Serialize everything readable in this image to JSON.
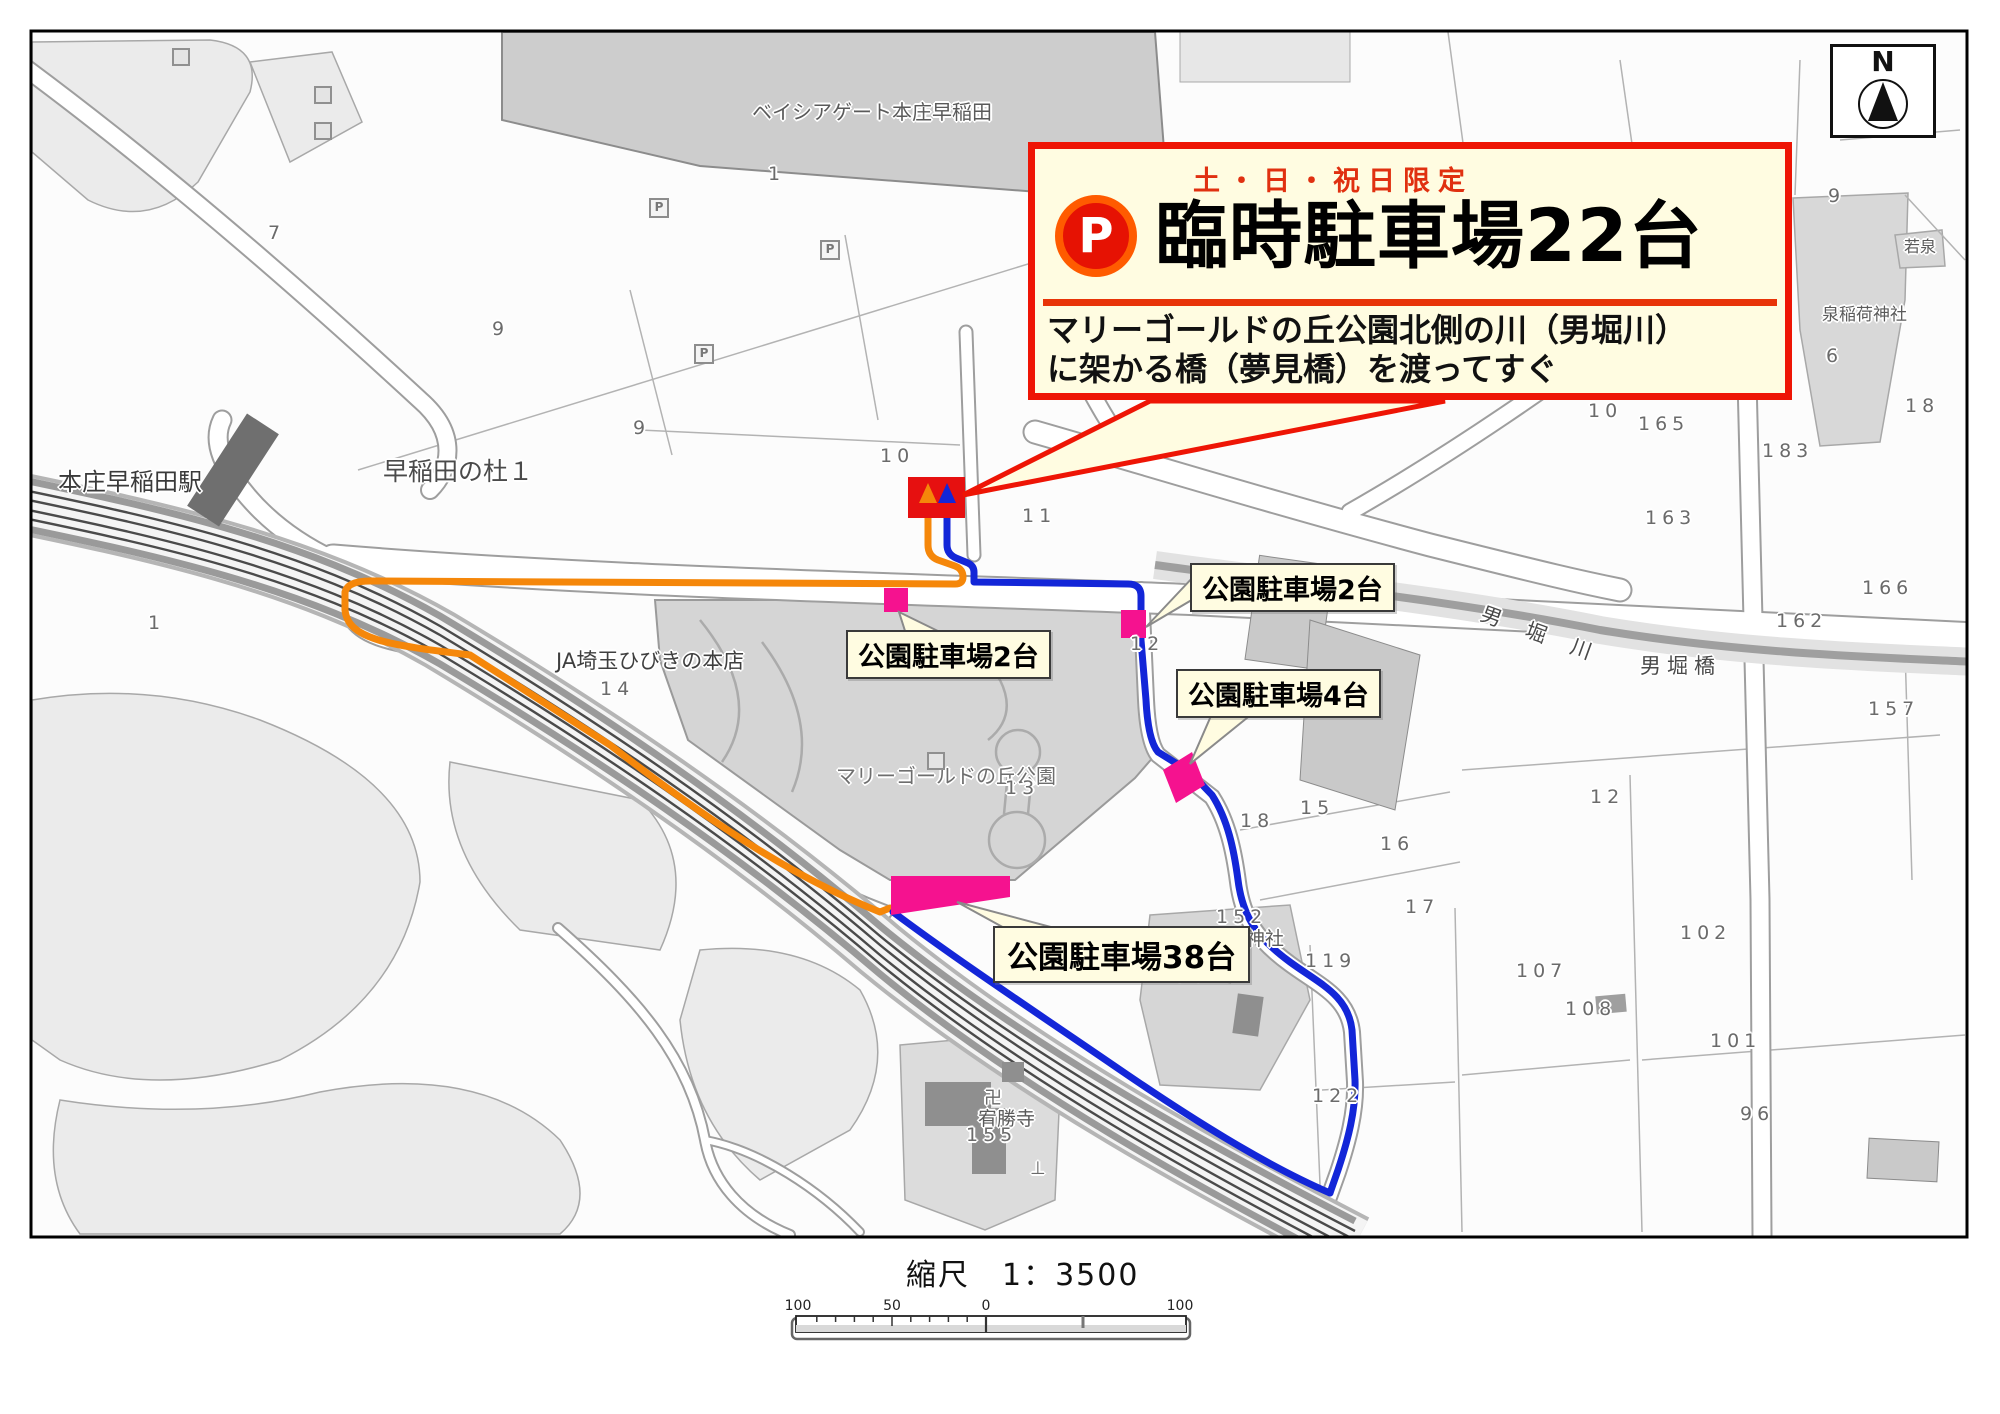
{
  "callout": {
    "badge": "P",
    "subtitle": "土・日・祝日限定",
    "title": "臨時駐車場22台",
    "body_line1": "マリーゴールドの丘公園北側の川（男堀川）",
    "body_line2": "に架かる橋（夢見橋）を渡ってすぐ"
  },
  "parking_labels": {
    "lot2_right": "公園駐車場2台",
    "lot2_left": "公園駐車場2台",
    "lot4": "公園駐車場4台",
    "lot38": "公園駐車場38台"
  },
  "compass": {
    "north": "N"
  },
  "scale": {
    "caption": "縮尺　1：3500",
    "ticks": [
      "100",
      "50",
      "0",
      "100"
    ]
  },
  "map": {
    "places": [
      {
        "t": "本庄早稲田駅",
        "x": 58,
        "y": 462,
        "s": 24,
        "c": "#3a3a3a"
      },
      {
        "t": "早稲田の杜１",
        "x": 383,
        "y": 452,
        "s": 25,
        "c": "#4a4a4a"
      },
      {
        "t": "ベイシアゲート本庄早稲田",
        "x": 752,
        "y": 96,
        "s": 20,
        "c": "#5a5a5a"
      },
      {
        "t": "JA埼玉ひびきの本店",
        "x": 556,
        "y": 645,
        "s": 21,
        "c": "#3f3f3f"
      },
      {
        "t": "マリーゴールドの丘公園",
        "x": 836,
        "y": 760,
        "s": 20,
        "c": "#6e6e6e"
      },
      {
        "t": "金鑚神社",
        "x": 1208,
        "y": 924,
        "s": 19,
        "c": "#5a5a5a"
      },
      {
        "t": "宥勝寺",
        "x": 978,
        "y": 1104,
        "s": 19,
        "c": "#5a5a5a"
      },
      {
        "t": "男 堀 川",
        "x": 1487,
        "y": 598,
        "s": 21,
        "c": "#4a4a4a",
        "r": 20,
        "ls": 10
      },
      {
        "t": "男堀橋",
        "x": 1640,
        "y": 650,
        "s": 21,
        "c": "#4a4a4a",
        "ls": 6
      },
      {
        "t": "泉稲荷神社",
        "x": 1822,
        "y": 300,
        "s": 17,
        "c": "#5a5a5a"
      },
      {
        "t": "若泉",
        "x": 1904,
        "y": 233,
        "s": 16,
        "c": "#5a5a5a"
      },
      {
        "t": "卍",
        "x": 984,
        "y": 1084,
        "s": 18,
        "c": "#6a6a6a"
      },
      {
        "t": "⊥",
        "x": 1030,
        "y": 1158,
        "s": 18,
        "c": "#6a6a6a"
      }
    ],
    "numbers": [
      {
        "t": "7",
        "x": 268,
        "y": 222
      },
      {
        "t": "9",
        "x": 492,
        "y": 318
      },
      {
        "t": "9",
        "x": 633,
        "y": 417
      },
      {
        "t": "1",
        "x": 768,
        "y": 163
      },
      {
        "t": "10",
        "x": 880,
        "y": 445
      },
      {
        "t": "11",
        "x": 1022,
        "y": 505
      },
      {
        "t": "12",
        "x": 1130,
        "y": 633
      },
      {
        "t": "13",
        "x": 1005,
        "y": 777
      },
      {
        "t": "14",
        "x": 600,
        "y": 678
      },
      {
        "t": "15",
        "x": 1300,
        "y": 797
      },
      {
        "t": "16",
        "x": 1380,
        "y": 833
      },
      {
        "t": "17",
        "x": 1405,
        "y": 896
      },
      {
        "t": "18",
        "x": 1240,
        "y": 810
      },
      {
        "t": "12",
        "x": 1590,
        "y": 786
      },
      {
        "t": "10",
        "x": 1588,
        "y": 400
      },
      {
        "t": "165",
        "x": 1638,
        "y": 413
      },
      {
        "t": "183",
        "x": 1762,
        "y": 440
      },
      {
        "t": "163",
        "x": 1645,
        "y": 507
      },
      {
        "t": "162",
        "x": 1776,
        "y": 610
      },
      {
        "t": "166",
        "x": 1862,
        "y": 577
      },
      {
        "t": "157",
        "x": 1868,
        "y": 698
      },
      {
        "t": "152",
        "x": 1216,
        "y": 906
      },
      {
        "t": "156",
        "x": 1158,
        "y": 964
      },
      {
        "t": "155",
        "x": 966,
        "y": 1124
      },
      {
        "t": "119",
        "x": 1305,
        "y": 950
      },
      {
        "t": "107",
        "x": 1516,
        "y": 960
      },
      {
        "t": "108",
        "x": 1565,
        "y": 998
      },
      {
        "t": "102",
        "x": 1680,
        "y": 922
      },
      {
        "t": "101",
        "x": 1710,
        "y": 1030
      },
      {
        "t": "96",
        "x": 1740,
        "y": 1103
      },
      {
        "t": "122",
        "x": 1312,
        "y": 1085
      },
      {
        "t": "9",
        "x": 1828,
        "y": 185
      },
      {
        "t": "6",
        "x": 1826,
        "y": 345
      },
      {
        "t": "18",
        "x": 1905,
        "y": 395
      },
      {
        "t": "246",
        "x": 1872,
        "y": 118
      },
      {
        "t": "1",
        "x": 148,
        "y": 612
      }
    ],
    "p_icons": [
      {
        "t": "P",
        "x": 649,
        "y": 198
      },
      {
        "t": "P",
        "x": 820,
        "y": 240
      },
      {
        "t": "P",
        "x": 694,
        "y": 344
      }
    ],
    "symbols": [
      {
        "t": "",
        "x": 172,
        "y": 48
      },
      {
        "t": "",
        "x": 314,
        "y": 86
      },
      {
        "t": "",
        "x": 314,
        "y": 122
      },
      {
        "t": "",
        "x": 927,
        "y": 752
      }
    ]
  }
}
